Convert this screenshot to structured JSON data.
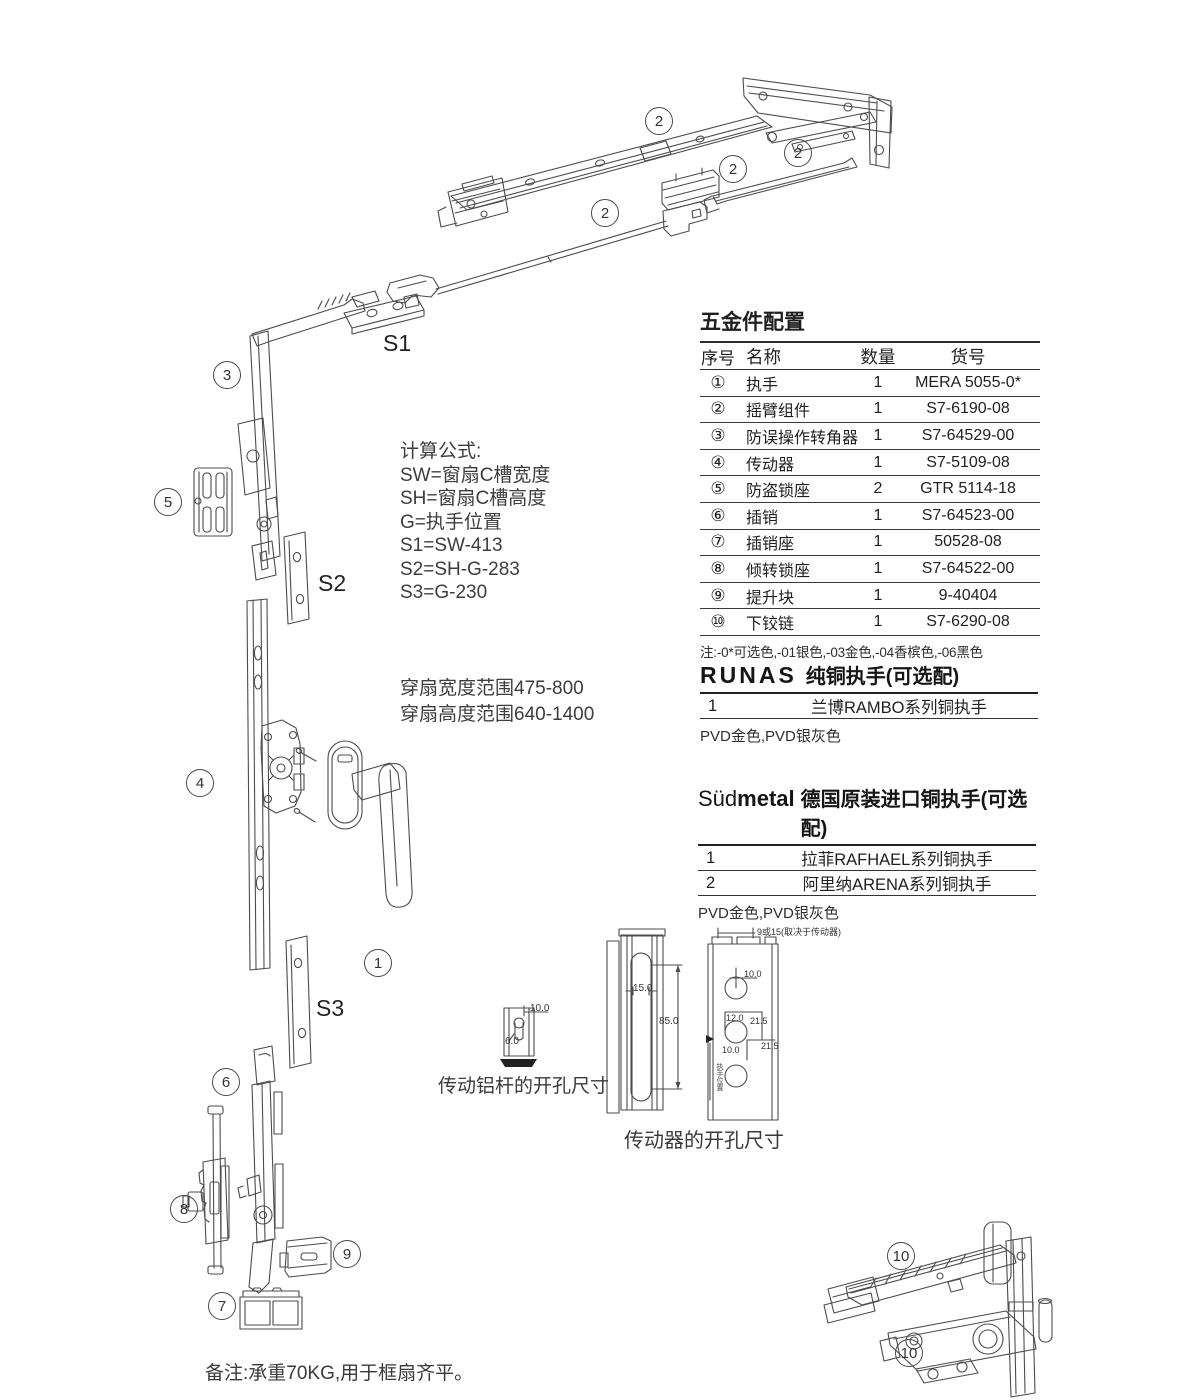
{
  "callouts": {
    "n1": "1",
    "n2": "2",
    "n3": "3",
    "n4": "4",
    "n5": "5",
    "n6": "6",
    "n7": "7",
    "n8": "8",
    "n9": "9",
    "n10": "10"
  },
  "s_labels": {
    "s1": "S1",
    "s2": "S2",
    "s3": "S3"
  },
  "formulas": {
    "title": "计算公式:",
    "lines": [
      "SW=窗扇C槽宽度",
      "SH=窗扇C槽高度",
      "G=执手位置",
      "S1=SW-413",
      "S2=SH-G-283",
      "S3=G-230"
    ]
  },
  "ranges": {
    "width": "穿扇宽度范围475-800",
    "height": "穿扇高度范围640-1400"
  },
  "hardware_table": {
    "title": "五金件配置",
    "headers": [
      "序号",
      "名称",
      "数量",
      "货号"
    ],
    "rows": [
      [
        "①",
        "执手",
        "1",
        "MERA 5055-0*"
      ],
      [
        "②",
        "摇臂组件",
        "1",
        "S7-6190-08"
      ],
      [
        "③",
        "防误操作转角器",
        "1",
        "S7-64529-00"
      ],
      [
        "④",
        "传动器",
        "1",
        "S7-5109-08"
      ],
      [
        "⑤",
        "防盗锁座",
        "2",
        "GTR 5114-18"
      ],
      [
        "⑥",
        "插销",
        "1",
        "S7-64523-00"
      ],
      [
        "⑦",
        "插销座",
        "1",
        "50528-08"
      ],
      [
        "⑧",
        "倾转锁座",
        "1",
        "S7-64522-00"
      ],
      [
        "⑨",
        "提升块",
        "1",
        "9-40404"
      ],
      [
        "⑩",
        "下铰链",
        "1",
        "S7-6290-08"
      ]
    ],
    "note": "注:-0*可选色,-01银色,-03金色,-04香槟色,-06黑色"
  },
  "runas": {
    "logo": "RUNAS",
    "title": "纯铜执手(可选配)",
    "rows": [
      [
        "1",
        "兰博RAMBO系列铜执手"
      ]
    ],
    "note": "PVD金色,PVD银灰色"
  },
  "sudmetal": {
    "logo_light": "Süd",
    "logo_bold": "metal",
    "title": "德国原装进口铜执手(可选配)",
    "rows": [
      [
        "1",
        "拉菲RAFHAEL系列铜执手"
      ],
      [
        "2",
        "阿里纳ARENA系列铜执手"
      ]
    ],
    "note": "PVD金色,PVD银灰色"
  },
  "dims": {
    "rod_caption": "传动铝杆的开孔尺寸",
    "gear_caption": "传动器的开孔尺寸",
    "rod_w": "10.0",
    "rod_h": "6.0",
    "slot_w": "15.0",
    "slot_h": "85.0",
    "frame_top": "9或15(取决于传动器)",
    "frame_d1": "10.0",
    "frame_d2": "12.0",
    "frame_d3": "21.5",
    "frame_d4": "21.5",
    "frame_d5": "10.0",
    "frame_side": "执手位置"
  },
  "footnote": "备注:承重70KG,用于框扇齐平。",
  "colors": {
    "line_art": "#4c4c4c",
    "text": "#2e2e2e"
  }
}
